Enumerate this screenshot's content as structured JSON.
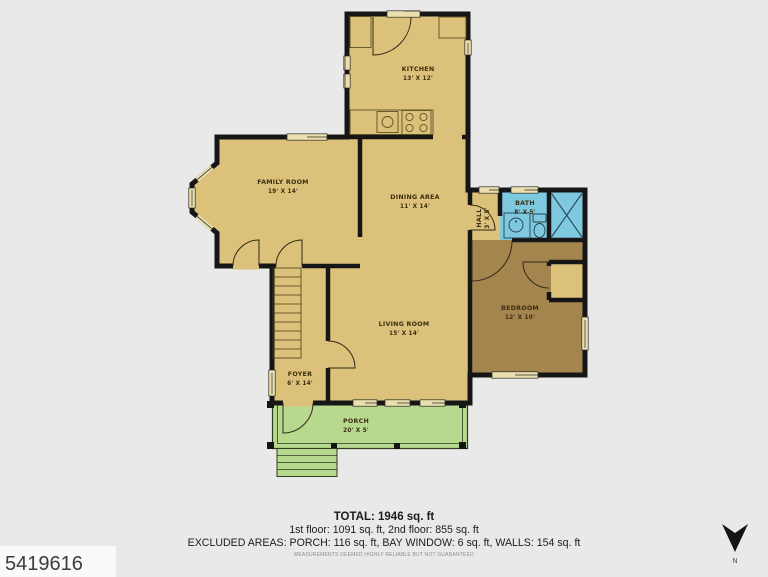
{
  "plan": {
    "rooms": {
      "kitchen": {
        "name": "KITCHEN",
        "dims": "13' X 12'"
      },
      "family_room": {
        "name": "FAMILY ROOM",
        "dims": "19' X 14'"
      },
      "dining_area": {
        "name": "DINING AREA",
        "dims": "11' X 14'"
      },
      "hall": {
        "name": "HALL",
        "dims": "3' X 5'"
      },
      "bath": {
        "name": "BATH",
        "dims": "8' X 5'"
      },
      "bedroom": {
        "name": "BEDROOM",
        "dims": "12' X 10'"
      },
      "living_room": {
        "name": "LIVING ROOM",
        "dims": "15' X 14'"
      },
      "foyer": {
        "name": "FOYER",
        "dims": "6' X 14'"
      },
      "porch": {
        "name": "PORCH",
        "dims": "20' X 5'"
      }
    }
  },
  "summary": {
    "total": "TOTAL: 1946 sq. ft",
    "floors": "1st floor: 1091 sq. ft, 2nd floor: 855 sq. ft",
    "excluded": "EXCLUDED AREAS: PORCH: 116 sq. ft, BAY WINDOW: 6 sq. ft, WALLS: 154 sq. ft",
    "disclaimer": "MEASUREMENTS DEEMED HIGHLY RELIABLE BUT NOT GUARANTEED"
  },
  "listing_id": "5419616",
  "compass": {
    "label": "N"
  },
  "colors": {
    "background": "#e9e9e9",
    "floor": "#dbc179",
    "window": "#ecdfae",
    "bedroom": "#a5854e",
    "bath": "#7fc9e0",
    "porch": "#b7d98e",
    "porch_line": "#2f3b22",
    "wall": "#161616",
    "id_box": "#fafafa"
  }
}
